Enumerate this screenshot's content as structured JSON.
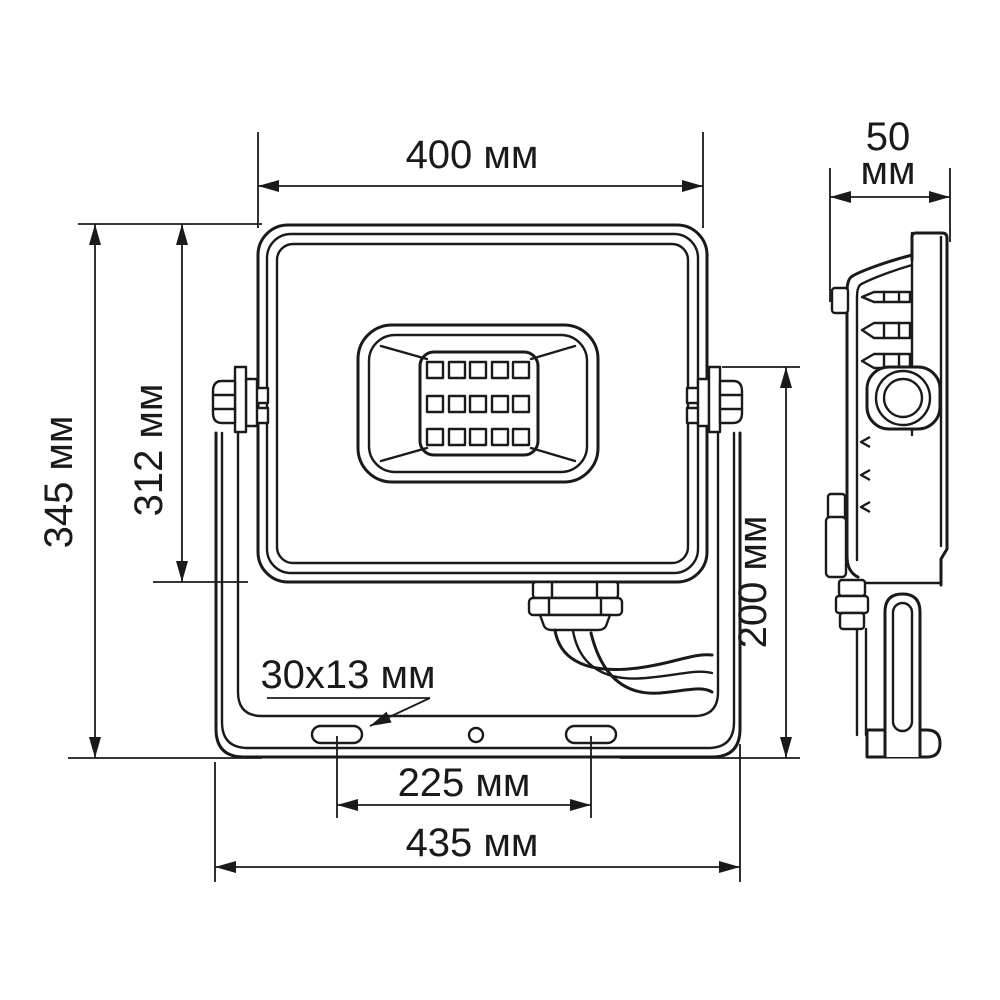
{
  "drawing": {
    "subject": "LED floodlight dimensional drawing",
    "units": "мм",
    "colors": {
      "line": "#1a1a1a",
      "background": "#ffffff"
    },
    "led_grid": {
      "rows": 3,
      "columns": 5
    }
  },
  "dimensions": {
    "front_width": "400 мм",
    "depth_value": "50",
    "depth_unit": "мм",
    "total_height": "345 мм",
    "body_height": "312 мм",
    "bracket_height": "200 мм",
    "slot_size": "30x13 мм",
    "hole_spacing": "225 мм",
    "bracket_width": "435 мм"
  }
}
